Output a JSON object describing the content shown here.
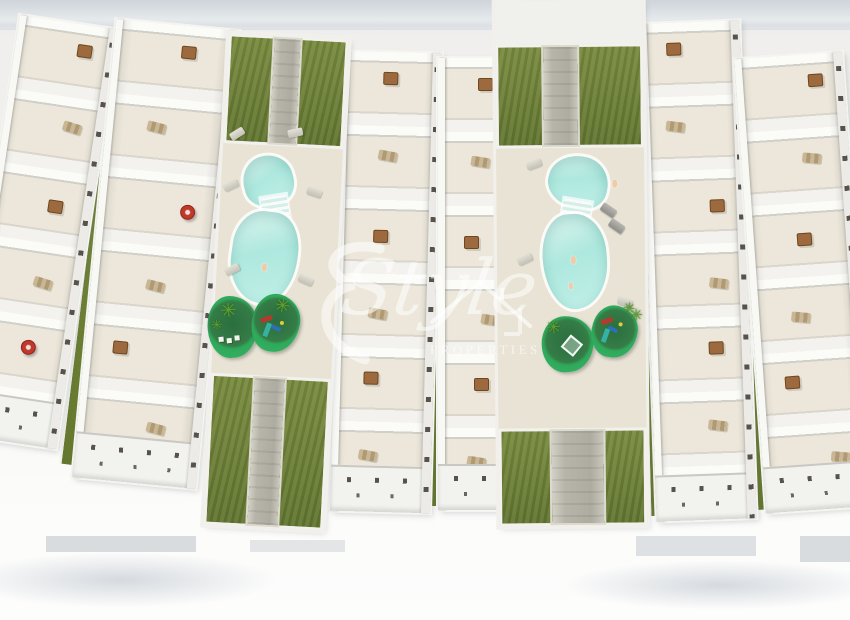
{
  "watermark": {
    "brand_script": "Style",
    "brand_caption": "PROPERTIES",
    "flourish_icon": "script-e-flourish-icon",
    "house_icon": "house-roof-outline-icon",
    "color": "#ffffff",
    "opacity": 0.55
  },
  "palette": {
    "background": "#f1f0ee",
    "building_white": "#f6f5f1",
    "terrace_floor": "#ece7da",
    "grass": "#798c3f",
    "walkway": "#b7b5a9",
    "pool_water": "#aee8de",
    "pool_water_light": "#d6f3ed",
    "deck": "#e8e3d5",
    "island_green": "#2fa85a",
    "palm_green": "#5ca132",
    "furniture_brown": "#9c6a3e",
    "umbrella_red": "#c0392b",
    "playground_red": "#b23b2e",
    "playground_blue": "#2e6fb5",
    "playground_teal": "#35b2a5",
    "shadow_gray": "#b4bcc5"
  },
  "scene": {
    "type": "aerial 3D architectural render of residential complex",
    "palm_glyph": "✳",
    "building_rows": [
      {
        "name": "building-row-1",
        "x": -12,
        "top": 20,
        "w": 100,
        "h": 424,
        "rot": 8.5,
        "units": 6,
        "umbrella": 4
      },
      {
        "name": "building-row-2",
        "x": 94,
        "top": 24,
        "w": 124,
        "h": 460,
        "rot": 5.5,
        "units": 6,
        "umbrella": 2
      },
      {
        "name": "building-row-3",
        "x": 336,
        "top": 52,
        "w": 100,
        "h": 460,
        "rot": 1.5,
        "units": 6
      },
      {
        "name": "building-row-4",
        "x": 438,
        "top": 58,
        "w": 80,
        "h": 452,
        "rot": 0,
        "units": 6
      },
      {
        "name": "building-row-5",
        "x": 648,
        "top": 22,
        "w": 100,
        "h": 498,
        "rot": -2,
        "units": 7
      },
      {
        "name": "building-row-6",
        "x": 750,
        "top": 55,
        "w": 108,
        "h": 455,
        "rot": -4,
        "units": 6
      }
    ],
    "green_slivers": [
      {
        "x": 86,
        "top": 30,
        "w": 12,
        "h": 436,
        "rot": 7
      },
      {
        "x": 428,
        "top": 62,
        "w": 11,
        "h": 444,
        "rot": 0.5
      },
      {
        "x": 488,
        "top": 60,
        "w": 9,
        "h": 450,
        "rot": 0
      },
      {
        "x": 643,
        "top": 28,
        "w": 10,
        "h": 488,
        "rot": -1.5
      },
      {
        "x": 742,
        "top": 42,
        "w": 11,
        "h": 468,
        "rot": -3.5
      }
    ],
    "pools": 2,
    "palm_islands": 4,
    "playgrounds": 2
  }
}
